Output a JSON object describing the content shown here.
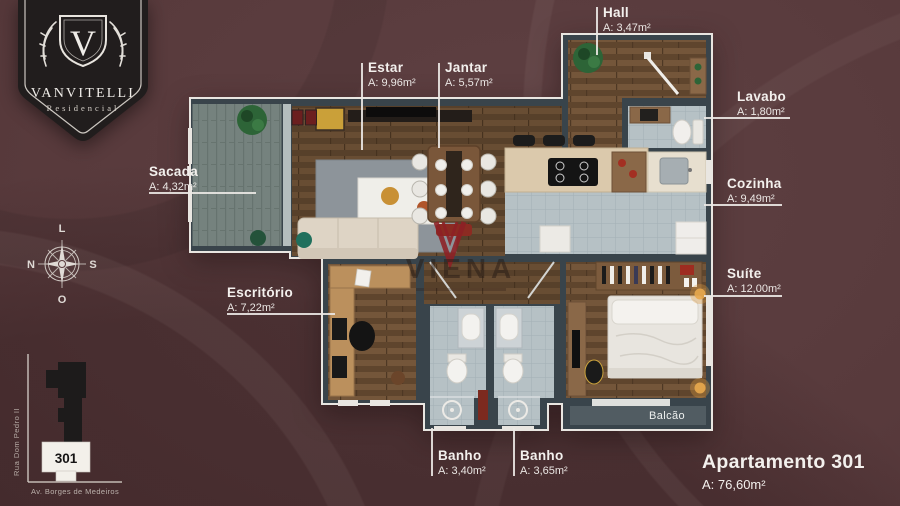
{
  "brand": {
    "monogram": "V",
    "name": "VANVITELLI",
    "subtitle": "Residencial"
  },
  "watermark": {
    "name": "VIENA"
  },
  "compass": {
    "top": "L",
    "left": "N",
    "right": "S",
    "bottom": "O"
  },
  "rooms": [
    {
      "id": "hall",
      "label": "Hall",
      "area": "A: 3,47m²"
    },
    {
      "id": "estar",
      "label": "Estar",
      "area": "A: 9,96m²"
    },
    {
      "id": "jantar",
      "label": "Jantar",
      "area": "A: 5,57m²"
    },
    {
      "id": "lavabo",
      "label": "Lavabo",
      "area": "A: 1,80m²"
    },
    {
      "id": "sacada",
      "label": "Sacada",
      "area": "A: 4,32m²"
    },
    {
      "id": "cozinha",
      "label": "Cozinha",
      "area": "A: 9,49m²"
    },
    {
      "id": "escritorio",
      "label": "Escritório",
      "area": "A: 7,22m²"
    },
    {
      "id": "suite",
      "label": "Suíte",
      "area": "A: 12,00m²"
    },
    {
      "id": "banho-1",
      "label": "Banho",
      "area": "A: 3,40m²"
    },
    {
      "id": "banho-2",
      "label": "Banho",
      "area": "A: 3,65m²"
    }
  ],
  "plan": {
    "balcony_label": "Balcão"
  },
  "apartment": {
    "title": "Apartamento 301",
    "area": "A: 76,60m²"
  },
  "site_map": {
    "street_left": "Rua Dom Pedro II",
    "street_bottom": "Av. Borges de Medeiros",
    "unit": "301"
  },
  "colors": {
    "background": "#583a3c",
    "wall": "#39444b",
    "wood": "#5f4730",
    "deck": "#75827e",
    "tile": "#b6c1c5",
    "label_text": "#f3f0ed",
    "brand_red": "#8e2025"
  }
}
